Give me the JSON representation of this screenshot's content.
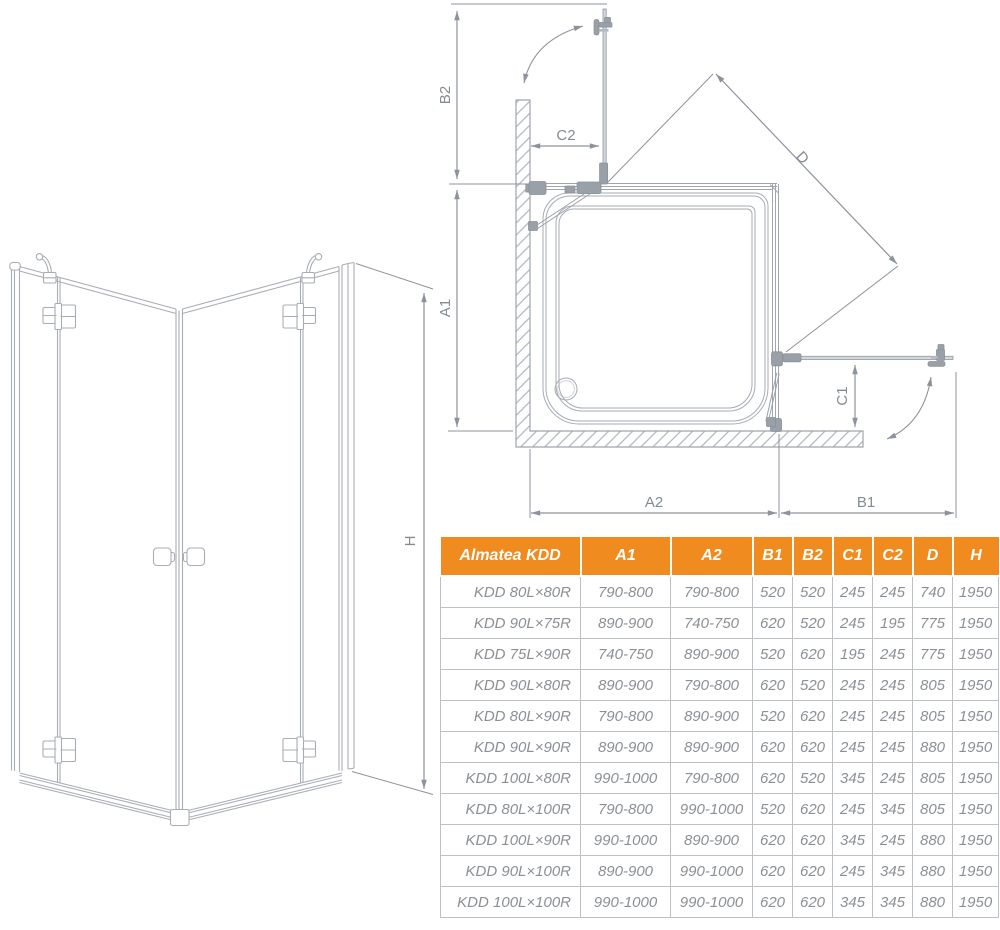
{
  "colors": {
    "accent_orange": "#ef8b1f",
    "drawing_line_gray": "#a6acb3",
    "dimension_gray": "#8d939b",
    "table_text_gray": "#8b9095",
    "table_border_gray": "#bcc1c6"
  },
  "view_3d": {
    "h_label": "H"
  },
  "top_view": {
    "b2": "B2",
    "c2": "C2",
    "a1": "A1",
    "a2": "A2",
    "b1": "B1",
    "c1": "C1",
    "d": "D"
  },
  "table": {
    "header": [
      "Almatea KDD",
      "A1",
      "A2",
      "B1",
      "B2",
      "C1",
      "C2",
      "D",
      "H"
    ],
    "rows": [
      [
        "KDD 80L×80R",
        "790-800",
        "790-800",
        "520",
        "520",
        "245",
        "245",
        "740",
        "1950"
      ],
      [
        "KDD 90L×75R",
        "890-900",
        "740-750",
        "620",
        "520",
        "245",
        "195",
        "775",
        "1950"
      ],
      [
        "KDD 75L×90R",
        "740-750",
        "890-900",
        "520",
        "620",
        "195",
        "245",
        "775",
        "1950"
      ],
      [
        "KDD 90L×80R",
        "890-900",
        "790-800",
        "620",
        "520",
        "245",
        "245",
        "805",
        "1950"
      ],
      [
        "KDD 80L×90R",
        "790-800",
        "890-900",
        "520",
        "620",
        "245",
        "245",
        "805",
        "1950"
      ],
      [
        "KDD 90L×90R",
        "890-900",
        "890-900",
        "620",
        "620",
        "245",
        "245",
        "880",
        "1950"
      ],
      [
        "KDD 100L×80R",
        "990-1000",
        "790-800",
        "620",
        "520",
        "345",
        "245",
        "805",
        "1950"
      ],
      [
        "KDD 80L×100R",
        "790-800",
        "990-1000",
        "520",
        "620",
        "245",
        "345",
        "805",
        "1950"
      ],
      [
        "KDD 100L×90R",
        "990-1000",
        "890-900",
        "620",
        "620",
        "345",
        "245",
        "880",
        "1950"
      ],
      [
        "KDD 90L×100R",
        "890-900",
        "990-1000",
        "620",
        "620",
        "245",
        "345",
        "880",
        "1950"
      ],
      [
        "KDD 100L×100R",
        "990-1000",
        "990-1000",
        "620",
        "620",
        "345",
        "345",
        "880",
        "1950"
      ]
    ]
  }
}
